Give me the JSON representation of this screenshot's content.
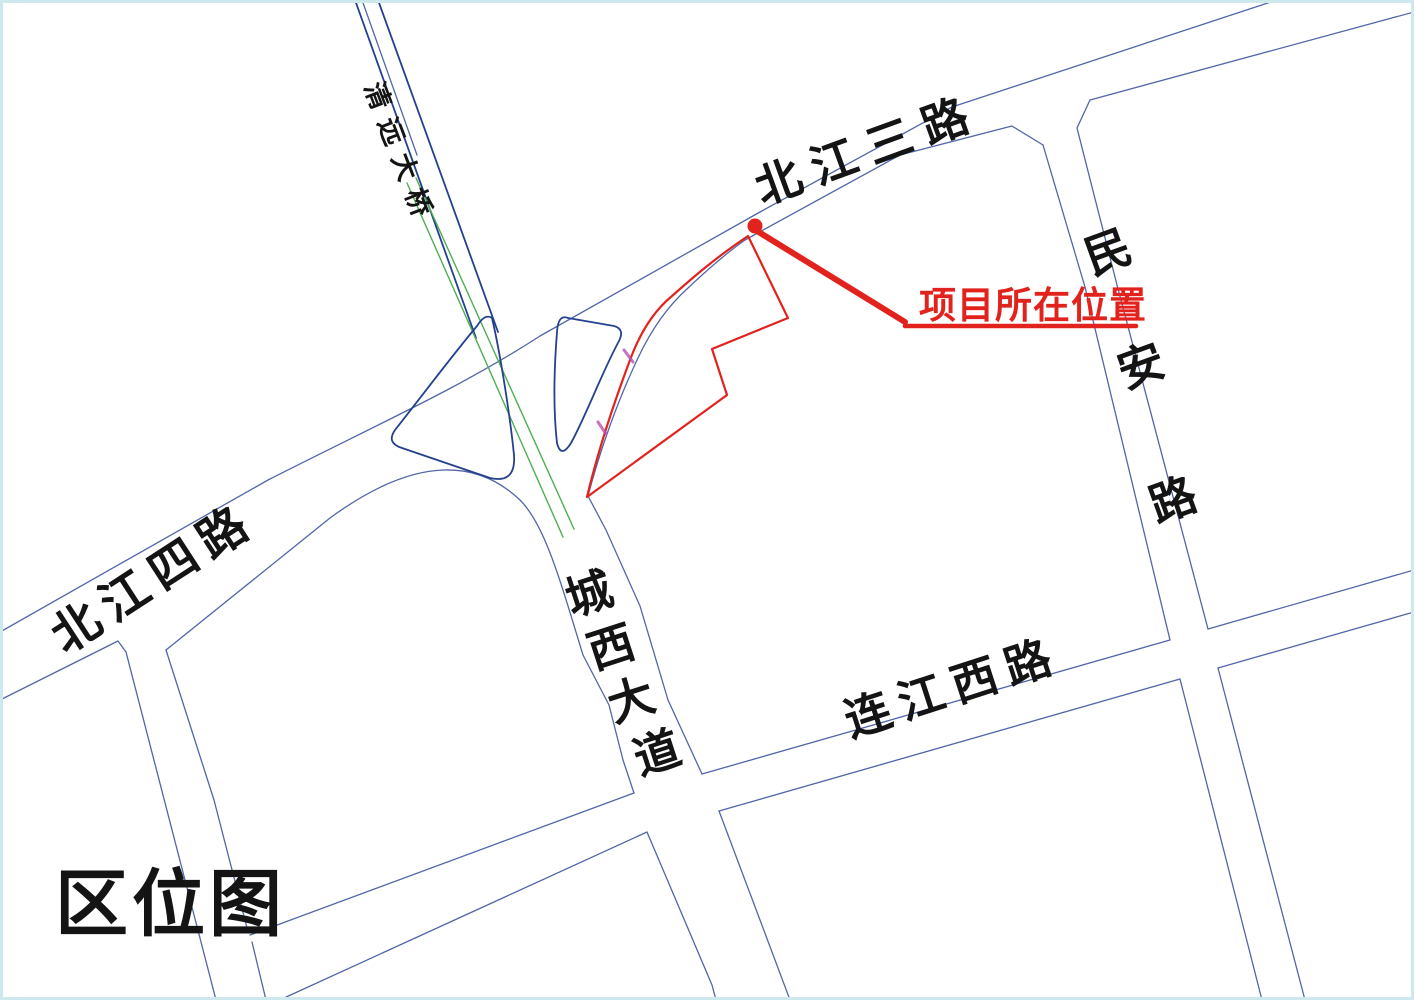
{
  "map": {
    "title": "区位图",
    "annotation": {
      "label": "项目所在位置"
    },
    "roads": {
      "bridge": {
        "name": "清远大桥"
      },
      "beijiang3": {
        "name": "北江三路"
      },
      "beijiang4": {
        "name": "北江四路"
      },
      "minan": {
        "name": "民安路",
        "chars": [
          "民",
          "安",
          "路"
        ]
      },
      "chengxi": {
        "name": "城西大道",
        "chars": [
          "城",
          "西",
          "大",
          "道"
        ]
      },
      "lianjiangxi": {
        "name": "连江西路"
      }
    },
    "colors": {
      "red": "#e2231d",
      "line": "#5166a8",
      "dark": "#24418f",
      "green": "#4fae52",
      "magenta": "#b84fb4",
      "frame": "#cde9ed",
      "ink": "#141414"
    }
  }
}
